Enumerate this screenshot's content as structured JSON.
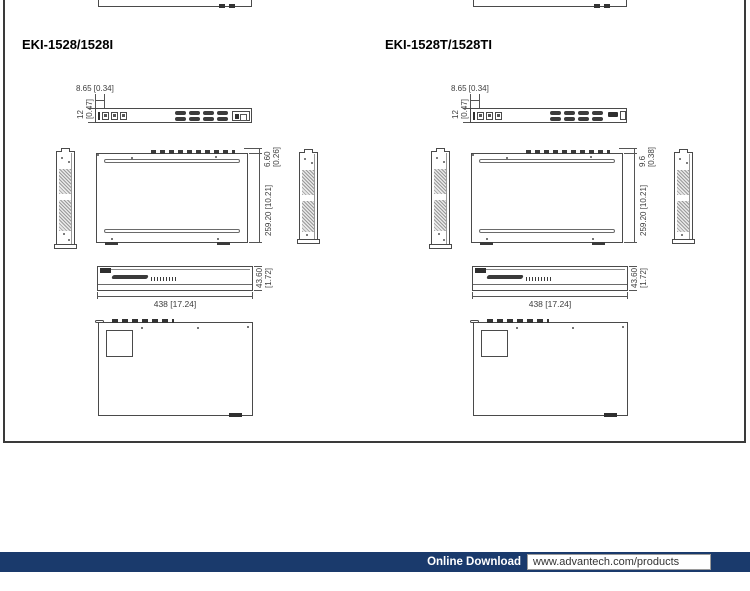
{
  "products": [
    {
      "title": "EKI-1528/1528I",
      "dims": {
        "front_offset": "8.65 [0.34]",
        "front_height_mm": "12",
        "front_height_in": "[0.47]",
        "top_offset_mm": "6.60",
        "top_offset_in": "[0.26]",
        "depth": "259.20 [10.21]",
        "rear_height_mm": "43.60",
        "rear_height_in": "[1.72]",
        "width": "438 [17.24]"
      }
    },
    {
      "title": "EKI-1528T/1528TI",
      "dims": {
        "front_offset": "8.65 [0.34]",
        "front_height_mm": "12",
        "front_height_in": "[0.47]",
        "top_offset_mm": "9.6",
        "top_offset_in": "[0.38]",
        "depth": "259.20 [10.21]",
        "rear_height_mm": "43.60",
        "rear_height_in": "[1.72]",
        "width": "438 [17.24]"
      }
    }
  ],
  "footer": {
    "download_label": "Online Download",
    "download_url": "www.advantech.com/products",
    "bar_color": "#1a3a6c"
  }
}
